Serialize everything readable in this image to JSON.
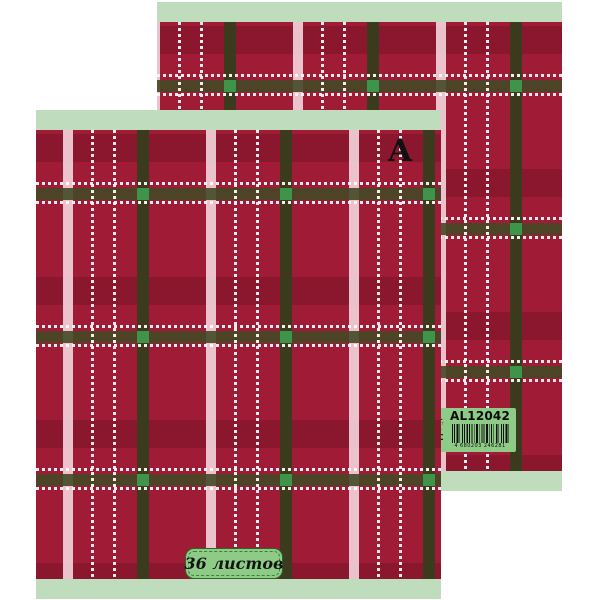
{
  "front_cover": {
    "brand_letter": "A",
    "sheets_label": "36 листов"
  },
  "back_cover": {
    "sticker": {
      "sku": "AL12042",
      "barcode_digits": "4 680203 246281",
      "logo_letter": "A",
      "logo_script": "Альт",
      "age_mark": "5+",
      "eac_mark": "ЕАС"
    }
  },
  "colors": {
    "base_red": "#A01C36",
    "strip_green": "#BFDCBC",
    "label_green": "#8DCB86",
    "label_border": "#2E652D",
    "label_dash": "#3C7F3B",
    "square_green": "#3E9549",
    "olive_v": "rgba(56,60,29,0.96)",
    "olive_h": "rgba(68,72,38,0.9)",
    "pink_stripe": "rgba(247,217,224,0.88)",
    "band_shadow": "rgba(25,0,8,0.16)",
    "dot_white": "rgba(255,247,247,0.95)",
    "ink": "#111111"
  }
}
